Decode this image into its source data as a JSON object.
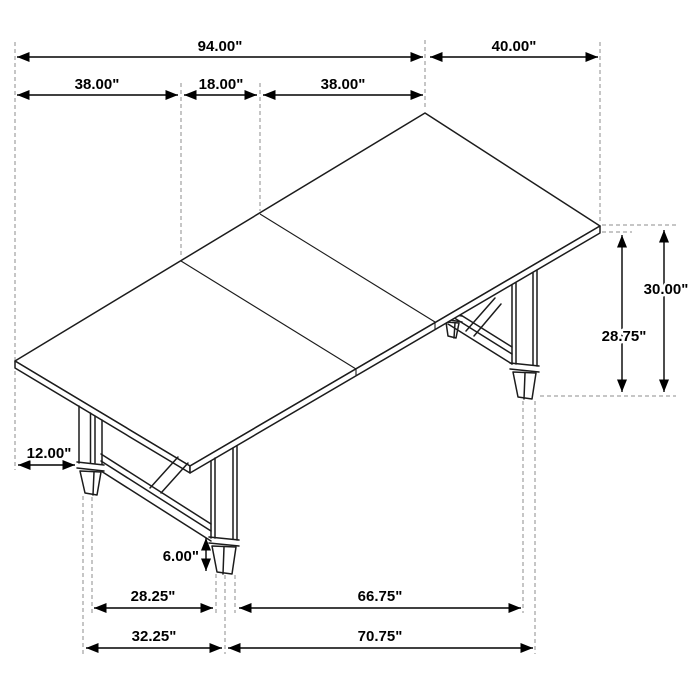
{
  "drawing": {
    "type": "isometric dimension line drawing",
    "subject": "extendable trestle dining table with leaf",
    "unit": "inches",
    "background_color": "#ffffff",
    "table_line_color": "#1c1c1c",
    "extension_line_color": "#8c8c8c",
    "dimension_line_color": "#000000"
  },
  "dimensions": {
    "total_length": "94.00\"",
    "top_width": "40.00\"",
    "left_section": "38.00\"",
    "leaf_section": "18.00\"",
    "right_section": "38.00\"",
    "overall_height": "30.00\"",
    "underside_height": "28.75\"",
    "leg_inset": "12.00\"",
    "foot_height": "6.00\"",
    "inner_span_left": "28.25\"",
    "inner_span_right": "66.75\"",
    "outer_span_left": "32.25\"",
    "outer_span_right": "70.75\""
  }
}
